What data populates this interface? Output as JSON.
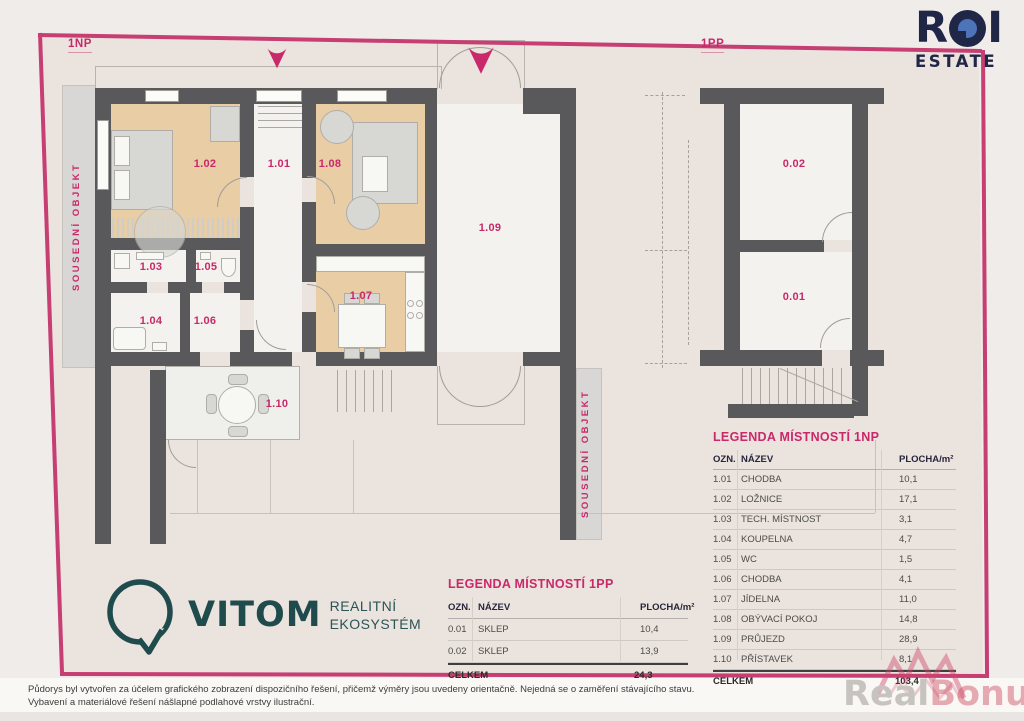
{
  "page": {
    "plan_np_label": "1NP",
    "plan_pp_label": "1PP",
    "neighbor_label": "SOUSEDNÍ OBJEKT"
  },
  "rooms_np": {
    "r101": "1.01",
    "r102": "1.02",
    "r103": "1.03",
    "r104": "1.04",
    "r105": "1.05",
    "r106": "1.06",
    "r107": "1.07",
    "r108": "1.08",
    "r109": "1.09",
    "r110": "1.10"
  },
  "rooms_pp": {
    "r001": "0.01",
    "r002": "0.02"
  },
  "legend_pp": {
    "title": "LEGENDA MÍSTNOSTÍ 1PP",
    "col_ozn": "OZN.",
    "col_nazev": "NÁZEV",
    "col_plocha": "PLOCHA/m²",
    "rows": [
      {
        "ozn": "0.01",
        "nazev": "SKLEP",
        "plocha": "10,4"
      },
      {
        "ozn": "0.02",
        "nazev": "SKLEP",
        "plocha": "13,9"
      }
    ],
    "total_label": "CELKEM",
    "total_value": "24,3"
  },
  "legend_np": {
    "title": "LEGENDA MÍSTNOSTÍ 1NP",
    "col_ozn": "OZN.",
    "col_nazev": "NÁZEV",
    "col_plocha": "PLOCHA/m²",
    "rows": [
      {
        "ozn": "1.01",
        "nazev": "CHODBA",
        "plocha": "10,1"
      },
      {
        "ozn": "1.02",
        "nazev": "LOŽNICE",
        "plocha": "17,1"
      },
      {
        "ozn": "1.03",
        "nazev": "TECH. MÍSTNOST",
        "plocha": "3,1"
      },
      {
        "ozn": "1.04",
        "nazev": "KOUPELNA",
        "plocha": "4,7"
      },
      {
        "ozn": "1.05",
        "nazev": "WC",
        "plocha": "1,5"
      },
      {
        "ozn": "1.06",
        "nazev": "CHODBA",
        "plocha": "4,1"
      },
      {
        "ozn": "1.07",
        "nazev": "JÍDELNA",
        "plocha": "11,0"
      },
      {
        "ozn": "1.08",
        "nazev": "OBÝVACÍ POKOJ",
        "plocha": "14,8"
      },
      {
        "ozn": "1.09",
        "nazev": "PRŮJEZD",
        "plocha": "28,9"
      },
      {
        "ozn": "1.10",
        "nazev": "PŘÍSTAVEK",
        "plocha": "8,1"
      }
    ],
    "total_label": "CELKEM",
    "total_value": "103,4"
  },
  "brand_roi": {
    "r": "R",
    "i": "I",
    "estate": "ESTATE"
  },
  "brand_vitom": {
    "name": "VITOM",
    "tag1": "REALITNÍ",
    "tag2": "EKOSYSTÉM"
  },
  "disclaimer": {
    "line1": "Půdorys byl vytvořen za účelem grafického zobrazení dispozičního řešení, přičemž výměry jsou uvedeny orientačně. Nejedná se o zaměření stávajícího stavu.",
    "line2": "Vybavení a materiálové řešení nášlapné podlahové vrstvy ilustrační."
  },
  "watermark": {
    "p1": "Real",
    "p2": "Bonus",
    "p3": ".cz"
  },
  "colors": {
    "accent": "#c9286a",
    "wall": "#59595b",
    "wood": "#e8cda5",
    "navy": "#202646",
    "teal": "#1f4b4d"
  }
}
